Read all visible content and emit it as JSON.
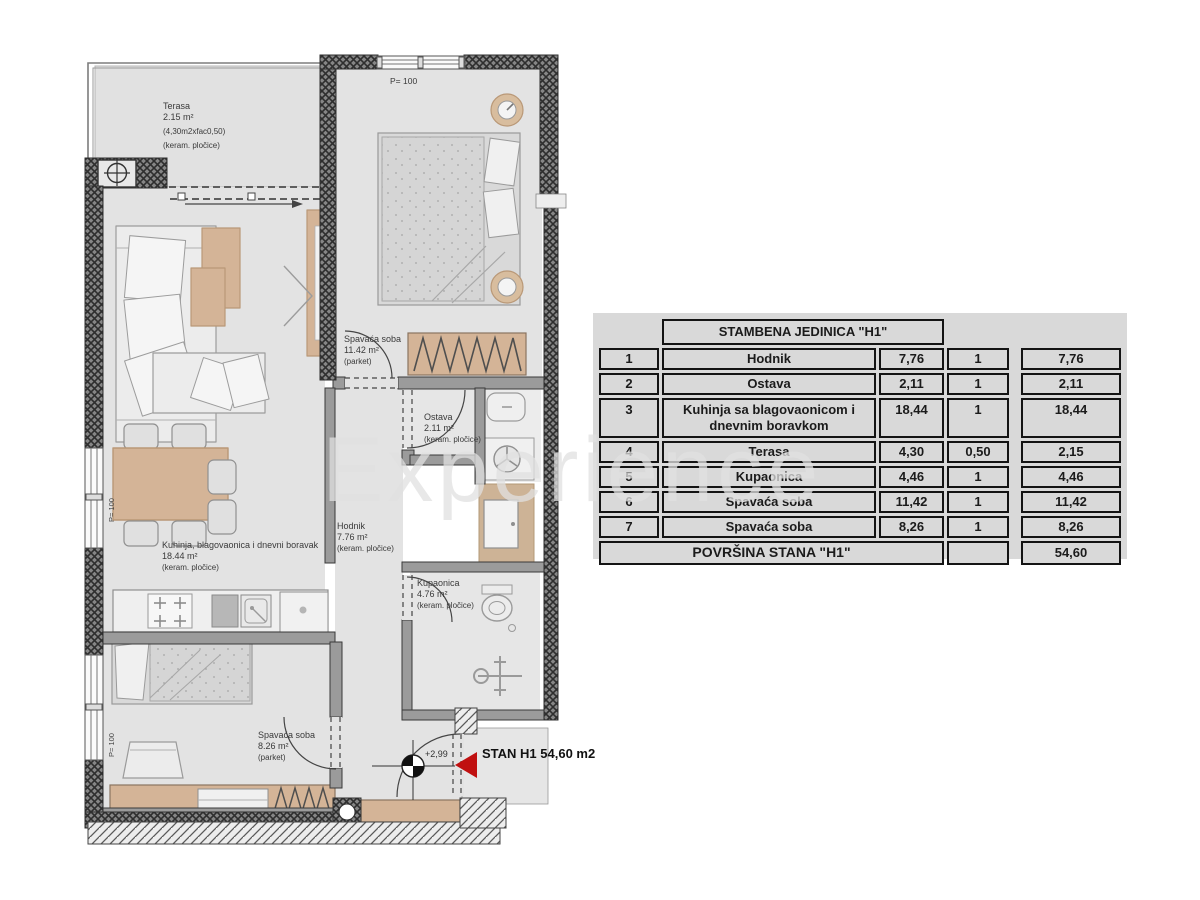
{
  "floor_plan": {
    "terrace": {
      "name": "Terasa",
      "area": "2.15 m²",
      "calc": "(4,30m2xfac0,50)",
      "floor": "(keram. pločice)"
    },
    "bedroom_top": {
      "name": "Spavaća soba",
      "area": "11.42 m²",
      "floor": "(parket)"
    },
    "living": {
      "name": "Kuhinja, blagovaonica i dnevni boravak",
      "area": "18.44 m²",
      "floor": "(keram. pločice)"
    },
    "hall": {
      "name": "Hodnik",
      "area": "7.76 m²",
      "floor": "(keram. pločice)"
    },
    "storage": {
      "name": "Ostava",
      "area": "2.11 m²",
      "floor": "(keram. pločice)"
    },
    "bathroom": {
      "name": "Kupaonica",
      "area": "4.76 m²",
      "floor": "(keram. pločice)"
    },
    "bedroom_bottom": {
      "name": "Spavaća soba",
      "area": "8.26 m²",
      "floor": "(parket)"
    },
    "window_label_top": "P= 100",
    "window_label_left1": "P= 100",
    "window_label_left2": "P= 100",
    "elevation": "+2,99",
    "unit_label": "STAN H1",
    "unit_area": "54,60 m2"
  },
  "table": {
    "header": "STAMBENA JEDINICA \"H1\"",
    "rows": [
      {
        "num": "1",
        "name": "Hodnik",
        "area": "7,76",
        "factor": "1",
        "total": "7,76"
      },
      {
        "num": "2",
        "name": "Ostava",
        "area": "2,11",
        "factor": "1",
        "total": "2,11"
      },
      {
        "num": "3",
        "name": "Kuhinja sa blagovaonicom i dnevnim boravkom",
        "area": "18,44",
        "factor": "1",
        "total": "18,44"
      },
      {
        "num": "4",
        "name": "Terasa",
        "area": "4,30",
        "factor": "0,50",
        "total": "2,15"
      },
      {
        "num": "5",
        "name": "Kupaonica",
        "area": "4,46",
        "factor": "1",
        "total": "4,46"
      },
      {
        "num": "6",
        "name": "Spavaća soba",
        "area": "11,42",
        "factor": "1",
        "total": "11,42"
      },
      {
        "num": "7",
        "name": "Spavaća soba",
        "area": "8,26",
        "factor": "1",
        "total": "8,26"
      }
    ],
    "footer_label": "POVRŠINA STANA \"H1\"",
    "footer_total": "54,60"
  },
  "watermark": "Experience",
  "colors": {
    "wall": "#868686",
    "floor": "#e3e3e3",
    "furniture_tan": "#d4b497",
    "accent_red": "#c01010"
  }
}
